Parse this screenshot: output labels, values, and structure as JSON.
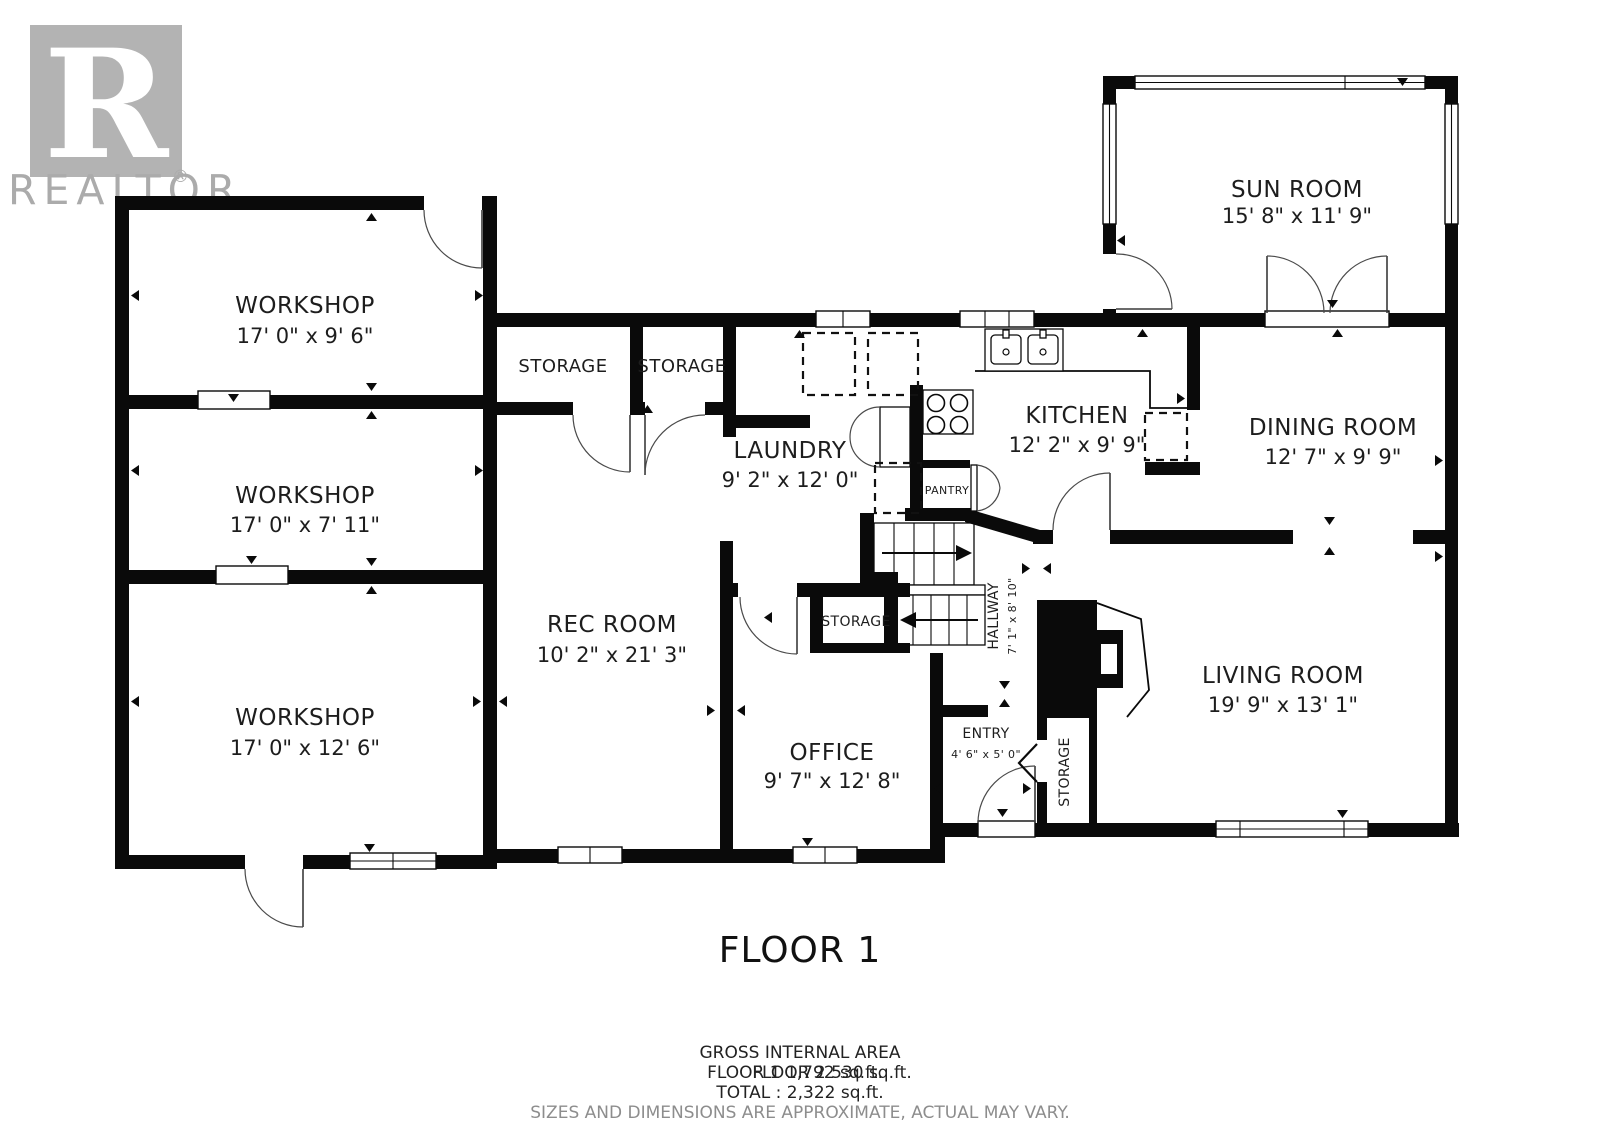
{
  "logo": {
    "symbol": "R",
    "brand": "REALTOR",
    "registered": "®"
  },
  "plan": {
    "floor_label": "FLOOR 1",
    "rooms": {
      "workshop1": {
        "name": "WORKSHOP",
        "dims": "17' 0\" x 9' 6\""
      },
      "workshop2": {
        "name": "WORKSHOP",
        "dims": "17' 0\" x 7' 11\""
      },
      "workshop3": {
        "name": "WORKSHOP",
        "dims": "17' 0\" x 12' 6\""
      },
      "storage1": {
        "name": "STORAGE"
      },
      "storage2": {
        "name": "STORAGE"
      },
      "laundry": {
        "name": "LAUNDRY",
        "dims": "9' 2\" x 12' 0\""
      },
      "rec_room": {
        "name": "REC ROOM",
        "dims": "10' 2\" x 21' 3\""
      },
      "office": {
        "name": "OFFICE",
        "dims": "9' 7\" x 12' 8\""
      },
      "storage_hall": {
        "name": "STORAGE"
      },
      "hallway": {
        "name": "HALLWAY",
        "dims": "7' 1\" x 8' 10\""
      },
      "entry": {
        "name": "ENTRY",
        "dims": "4' 6\" x 5' 0\""
      },
      "storage_entry": {
        "name": "STORAGE"
      },
      "pantry": {
        "name": "PANTRY"
      },
      "kitchen": {
        "name": "KITCHEN",
        "dims": "12' 2\" x 9' 9\""
      },
      "dining": {
        "name": "DINING ROOM",
        "dims": "12' 7\" x 9' 9\""
      },
      "living": {
        "name": "LIVING ROOM",
        "dims": "19' 9\" x 13' 1\""
      },
      "sunroom": {
        "name": "SUN ROOM",
        "dims": "15' 8\" x 11' 9\""
      }
    }
  },
  "footer": {
    "area_title": "GROSS INTERNAL AREA",
    "floor1_area": "FLOOR 1 1,792 sq.ft.",
    "floor2_area": "FLOOR 2 530 sq.ft.",
    "total_area": "TOTAL :  2,322 sq.ft.",
    "disclaimer": "SIZES AND DIMENSIONS ARE APPROXIMATE, ACTUAL MAY VARY."
  }
}
